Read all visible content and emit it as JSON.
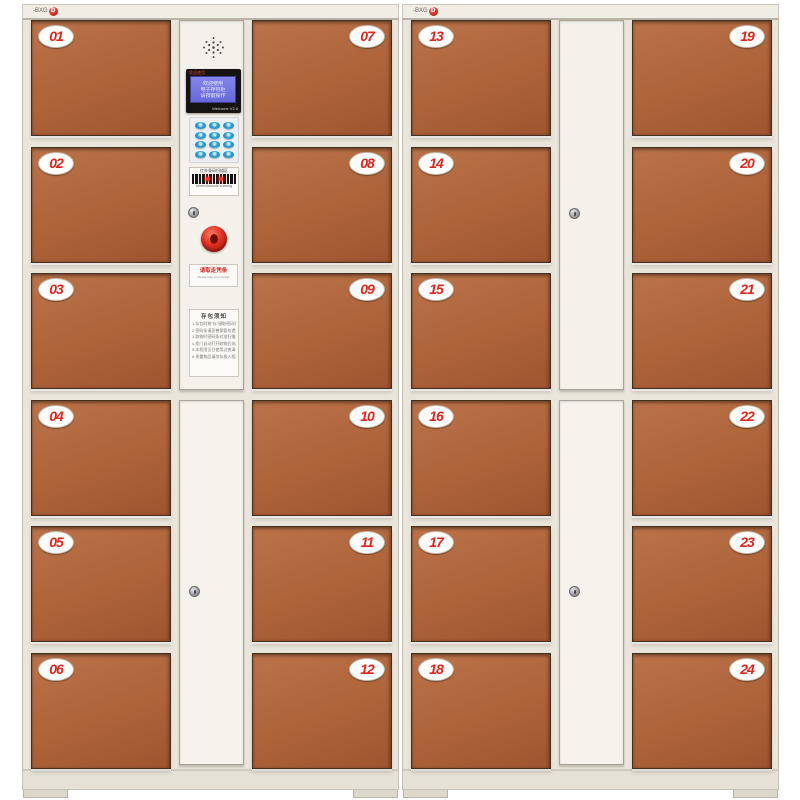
{
  "product": {
    "description": "24-door electronic smart storage locker, two cabinet units",
    "door_color": "#ae6339",
    "frame_color": "#e9e5db",
    "badge_red": "#e1251b",
    "lcd_blue": "#6f71e0",
    "keypad_blue": "#2da0d8",
    "button_red": "#e03022"
  },
  "brand": {
    "text": "-BXG",
    "badge_letter": "D"
  },
  "doors": [
    {
      "num": "01"
    },
    {
      "num": "02"
    },
    {
      "num": "03"
    },
    {
      "num": "04"
    },
    {
      "num": "05"
    },
    {
      "num": "06"
    },
    {
      "num": "07"
    },
    {
      "num": "08"
    },
    {
      "num": "09"
    },
    {
      "num": "10"
    },
    {
      "num": "11"
    },
    {
      "num": "12"
    },
    {
      "num": "13"
    },
    {
      "num": "14"
    },
    {
      "num": "15"
    },
    {
      "num": "16"
    },
    {
      "num": "17"
    },
    {
      "num": "18"
    },
    {
      "num": "19"
    },
    {
      "num": "20"
    },
    {
      "num": "21"
    },
    {
      "num": "22"
    },
    {
      "num": "23"
    },
    {
      "num": "24"
    }
  ],
  "console": {
    "lcd": {
      "bezel_label": "欢迎使用",
      "lines": [
        "欢迎使用",
        "电子存包柜",
        "请按键操作"
      ],
      "footer": "Welcome V2.0"
    },
    "scanner": {
      "top_label": "红外条码扫描区",
      "bottom_label": "Infrared barcode scanning"
    },
    "receipt": {
      "line1": "请取走凭条",
      "line2": "Please take your receipt"
    },
    "notice": {
      "title": "存包须知",
      "lines": [
        "1.存包时按\"存\"键取密码条",
        "2.密码条请妥善保管勿遗失",
        "3.取物时密码条对准扫描口",
        "4.柜门自动打开取物后关门",
        "5.本柜限当日使用过夜清柜",
        "6.贵重物品请勿存放入柜内"
      ]
    }
  }
}
